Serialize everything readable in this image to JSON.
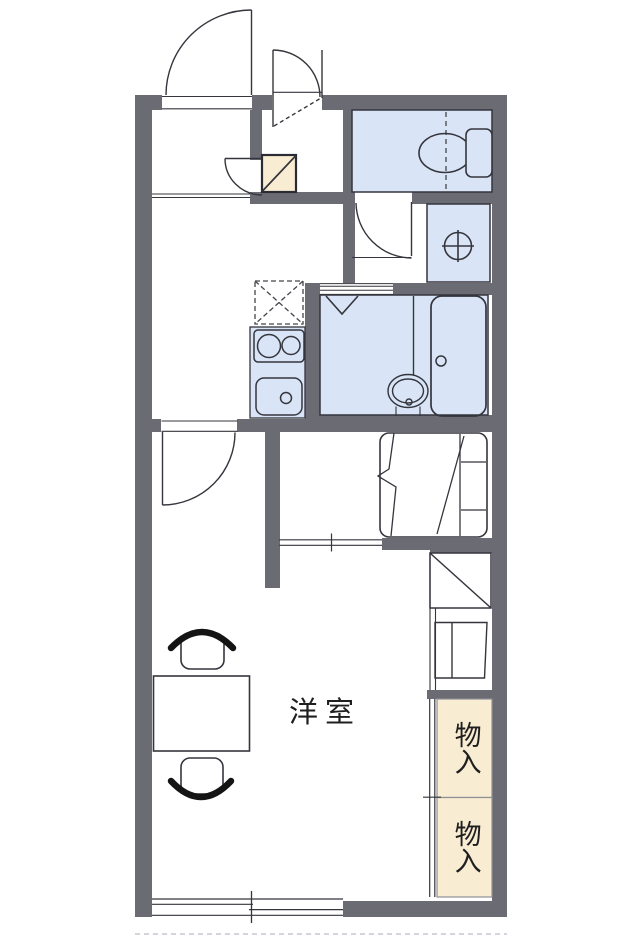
{
  "plan": {
    "labels": {
      "western_room": "洋室",
      "storage_upper": "物入",
      "storage_lower": "物入"
    },
    "colors": {
      "wall": "#6b6b73",
      "fixture_fill": "#d9e5f6",
      "storage_fill": "#f8ecd2",
      "line": "#35353d",
      "background": "#ffffff",
      "text": "#1f1f1f"
    },
    "icons": [
      "entrance-door",
      "closet-door",
      "shoe-cabinet",
      "entrance-step-lines",
      "toilet",
      "toilet-door",
      "washing-machine-space",
      "bath-folding-door",
      "shower-mark",
      "wash-basin",
      "bathtub",
      "bath-partition",
      "refrigerator-space",
      "stove",
      "sink",
      "room-door",
      "bed",
      "sliding-door",
      "storage-box",
      "shelf-unit",
      "table",
      "chair",
      "sliding-window",
      "balcony-dashed-line"
    ]
  }
}
